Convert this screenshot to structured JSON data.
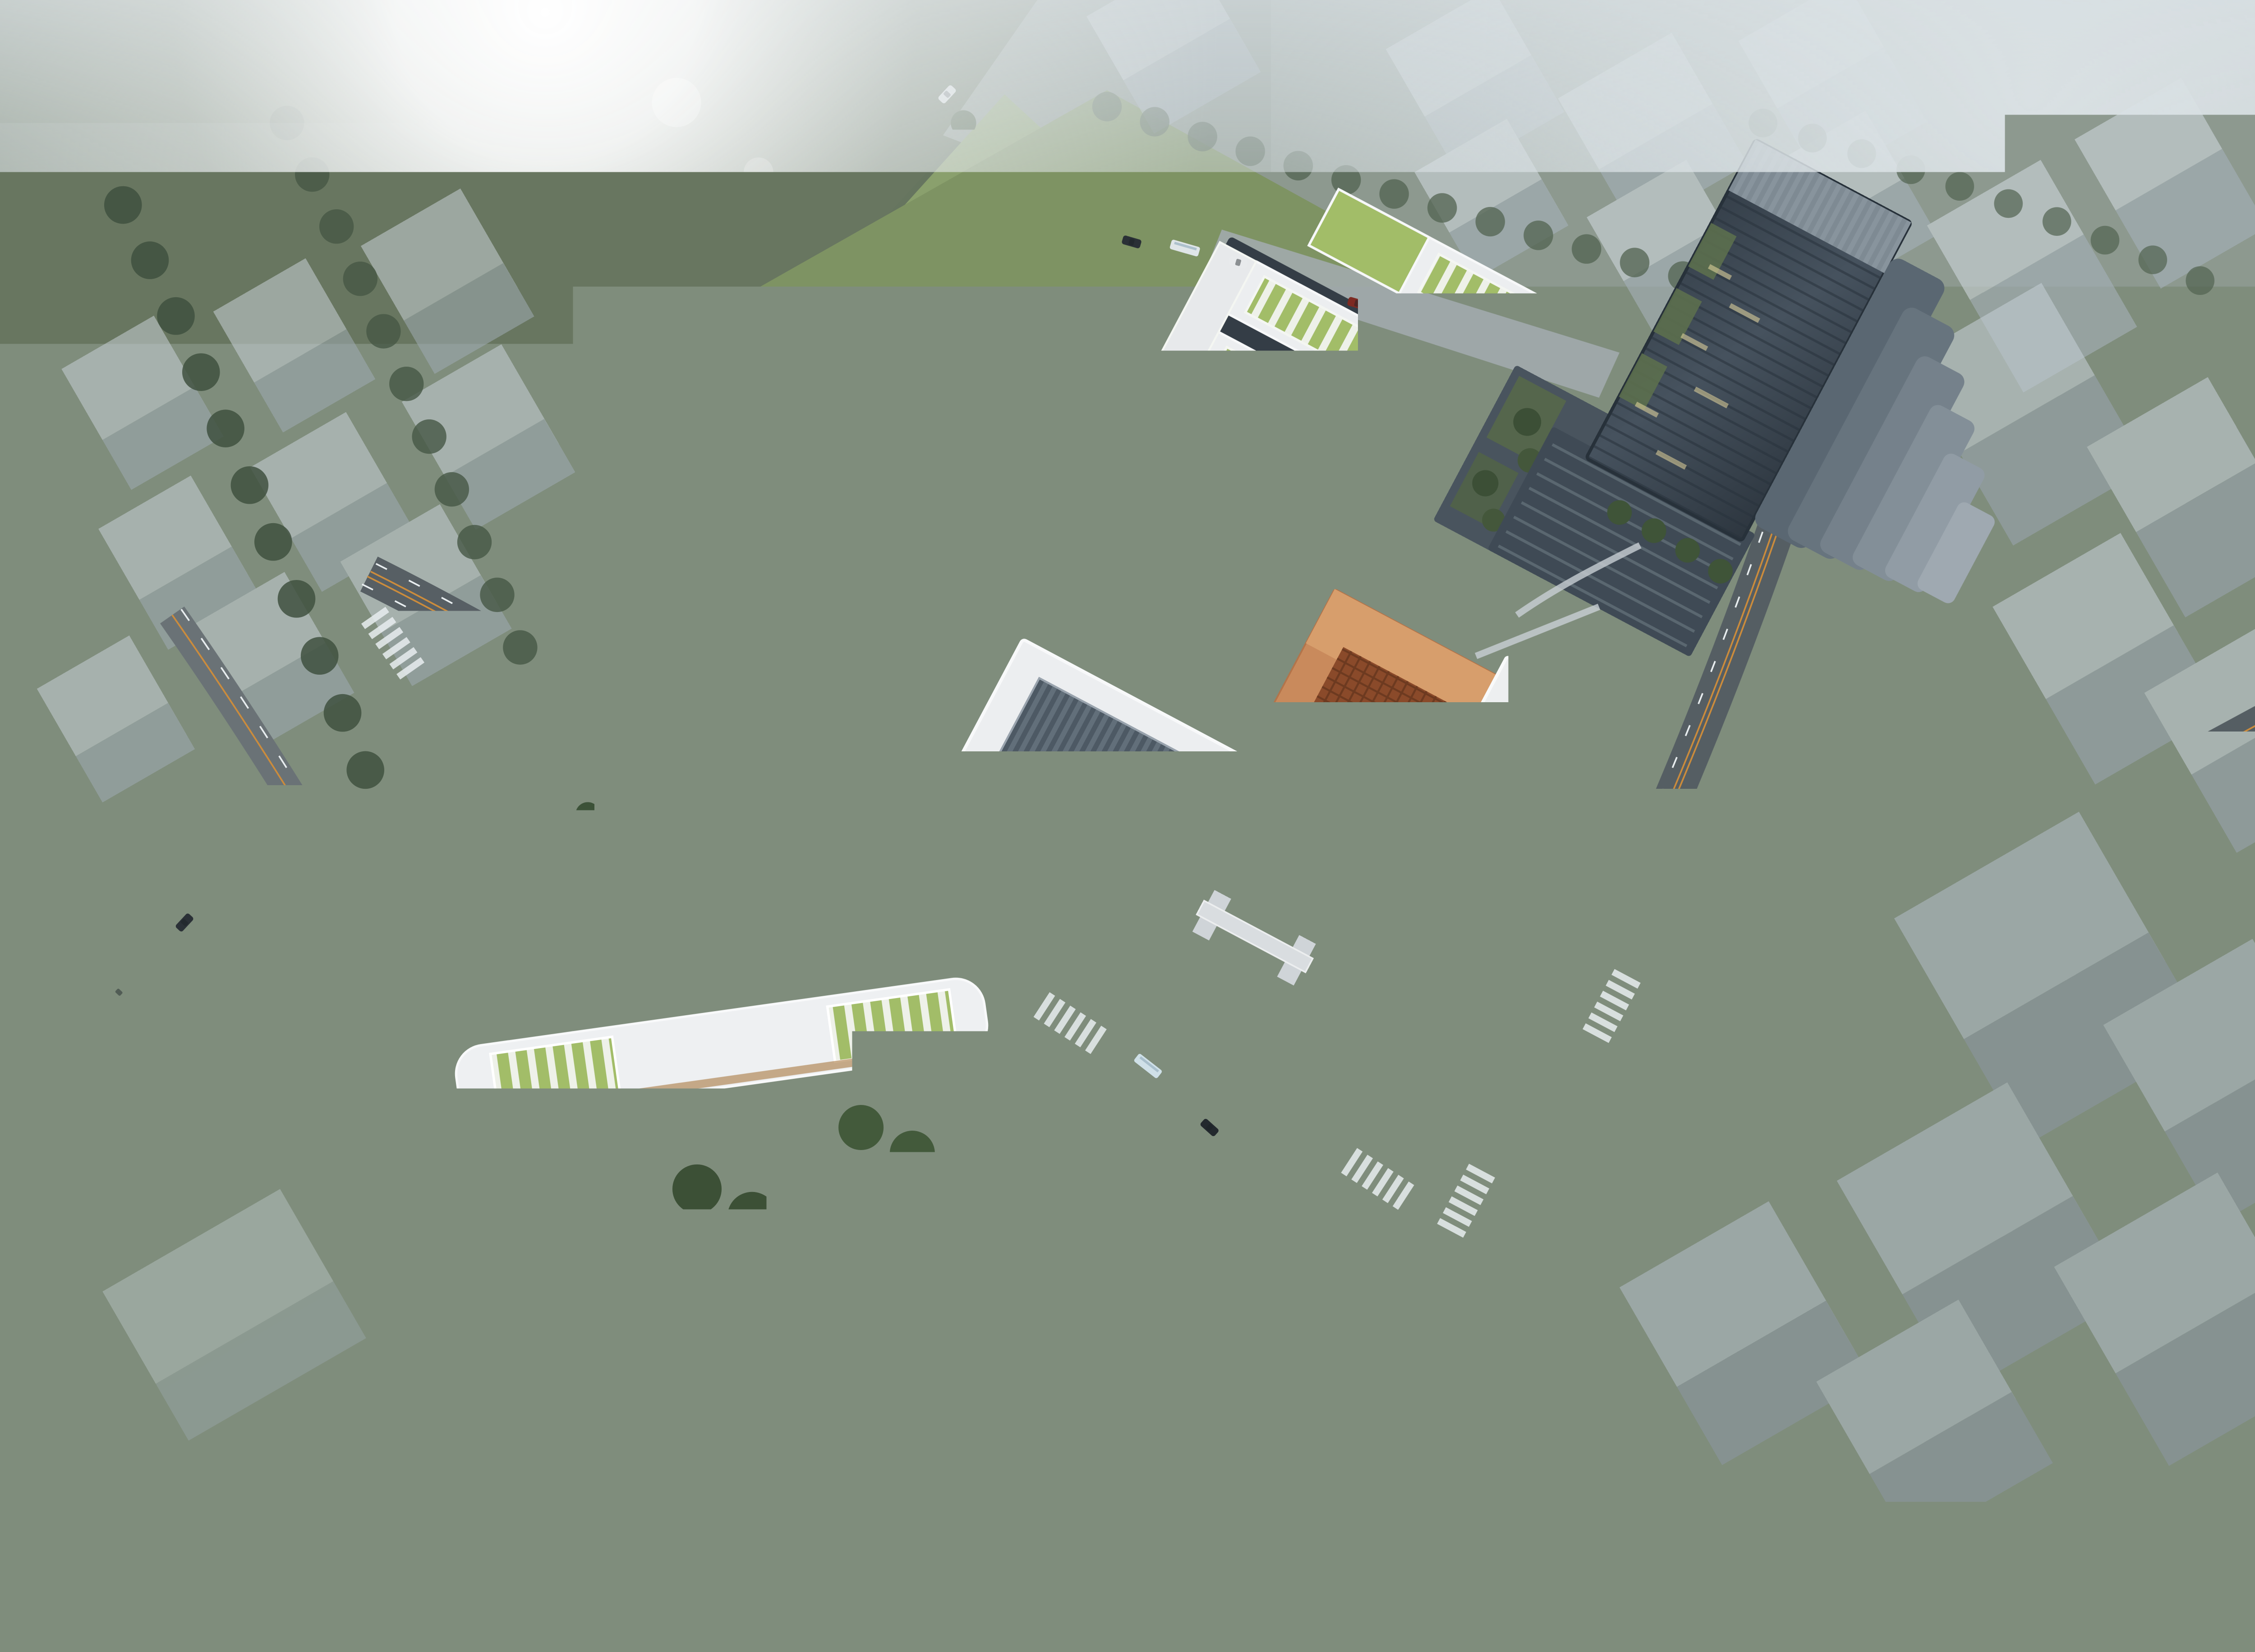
{
  "image": {
    "type": "aerial-architectural-rendering",
    "subject": "school campus masterplan with sports fields, classroom bars, copper hall, tower and kindergarten in foggy city context",
    "view": "oblique bird's-eye view",
    "lighting": "hazy morning sun flare from upper left, dusk-dark streets lower right"
  },
  "palette": {
    "fog": "#d3dade",
    "context_ground": "#66755f",
    "park_lawn": "#8aa06d",
    "campus_lawn": "#7e9363",
    "forest": "#263123",
    "highway": "#9ba4a8",
    "road_dark": "#565e63",
    "marking_white": "#e9eef0",
    "marking_orange": "#cc8c3c",
    "track_blue": "#5878a6",
    "field_green": "#7e9d5c",
    "court_green": "#82a26b",
    "court_pad_blue": "#5b84b2",
    "tennis_pad_red": "#9a585c",
    "roof_white": "#eceef0",
    "roof_green_strip": "#a2bd68",
    "facade_dark": "#343d46",
    "copper_building": "#c98a5c",
    "copper_lattice": "#8a4a2a",
    "tower_glass": "#39434e",
    "ghost_block": "#c6d0d6",
    "pond_blue": "#5d7d96",
    "seal_red": "#a23b30",
    "warm_glow": "#d7a15e"
  },
  "landmarks": {
    "running_track": {
      "label": "blue running track with soccer field",
      "lanes": 6
    },
    "basketball_courts": {
      "label": "basketball courts",
      "count": 4
    },
    "tennis_court": {
      "label": "tennis court on red pad"
    },
    "classroom_complex": {
      "label": "white classroom bars with green skylight strips"
    },
    "gymnasium": {
      "label": "gymnasium with folded dark skylight roof"
    },
    "copper_hall": {
      "label": "copper lattice cultural hall with school seal"
    },
    "library": {
      "label": "white library block with grey skylight"
    },
    "tower": {
      "label": "dark glass tower with cascading terraces"
    },
    "kindergarten": {
      "label": "X-shaped kindergarten with green roof panels"
    },
    "entry_plaza": {
      "label": "paved entry plaza with green strips"
    },
    "pond_pavilion": {
      "label": "pavilion with fountain pond"
    },
    "highway": {
      "label": "elevated highway and interchange ramps"
    },
    "context_blocks": {
      "label": "translucent massing blocks in fog"
    }
  },
  "signage": {
    "seal_character": "實",
    "school_name": "温州市实验中学"
  }
}
